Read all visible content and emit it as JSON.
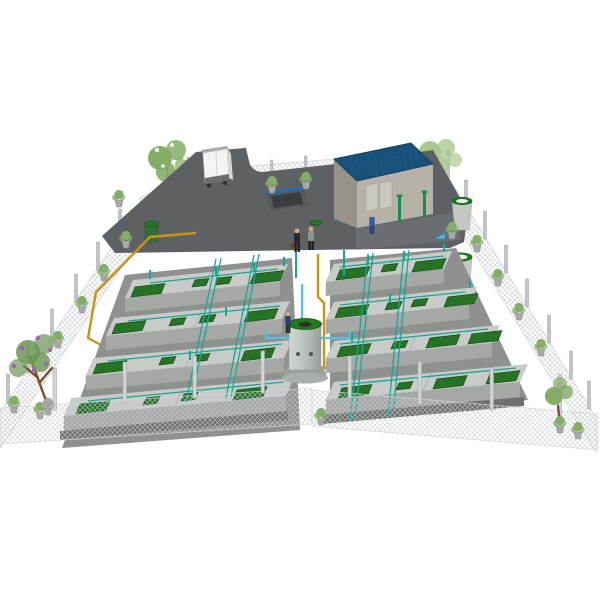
{
  "page": {
    "title": "Wastewater treatment plant — 3D site visualization",
    "background": "#ffffff"
  },
  "colors": {
    "pavement": "#5e6164",
    "pavement_light": "#75787b",
    "roof": "#1a5580",
    "roof_line": "#123f61",
    "wall_front": "#b6b2a7",
    "wall_side": "#97938a",
    "door": "#cbc8bf",
    "lid_green": "#267326",
    "rim_green": "#1f7a1f",
    "rim_hole": "#2a2e2a",
    "tank_top": "#c9cbc9",
    "tank_front": "#a6a8a6",
    "tank_side": "#8f918f",
    "tank_base": "#6e726e",
    "pipe_teal": "#18a795",
    "pipe_cyan": "#4fc3e8",
    "pipe_yellow": "#c9940f",
    "fence_panel": "#ececec",
    "cyl_body": "#c2c7c2",
    "cyl_inner": "#e8ece8",
    "bin_green": "#356e35",
    "truck_body": "#f4f4f2",
    "truck_roof": "#a7aaaa",
    "truck_bumper": "#6a6e70",
    "pit_wall": "#55595c",
    "pit_deep": "#393d40",
    "pit_rail": "#1e6fb5",
    "vent_green": "#1c8a50",
    "valve_cyan": "#3fb9d8",
    "foliage": "#84ad68",
    "foliage_light": "#a9c98e",
    "foliage_dark": "#6a9652",
    "blossom_white": "#f3f6ee",
    "blossom_purple": "#a55bc4",
    "worker_dark": "#262833",
    "worker_gray": "#8d948b",
    "worker_blue": "#2f5ba8",
    "worker_navy": "#2b3f6e",
    "worker_legs": "#1d1f26"
  },
  "scene": {
    "paved_yard": {
      "label": "paved service yard"
    },
    "vehicle": {
      "label": "delivery van"
    },
    "ramp": {
      "label": "underground access ramp with blue railing"
    },
    "manhole": {
      "label": "green manhole cover"
    },
    "building": {
      "label": "plant building",
      "roof": "blue panel roof",
      "doors": 2,
      "vent_pipes": 2
    },
    "tank_blocks": [
      {
        "label": "left tank block",
        "rows": 4,
        "lids_per_row": 4
      },
      {
        "label": "right tank block",
        "rows": 4,
        "lids_per_row": 4
      }
    ],
    "central_tank": {
      "label": "central cylindrical tank with green rim"
    },
    "storage_cylinders": {
      "label": "green-rimmed storage cylinders",
      "count": 2
    },
    "bins": {
      "label": "green waste bins",
      "count": 2
    },
    "workers": {
      "count": 4
    },
    "trees": {
      "count": 4
    },
    "potted_plants": {
      "label": "potted shrubs along fence"
    },
    "fence": {
      "label": "perimeter chain-link fence with concrete posts"
    },
    "pipes": {
      "teal": "process piping over tank rows",
      "cyan": "transfer piping at central tank",
      "yellow": "supply piping along west side and central aisle"
    }
  }
}
